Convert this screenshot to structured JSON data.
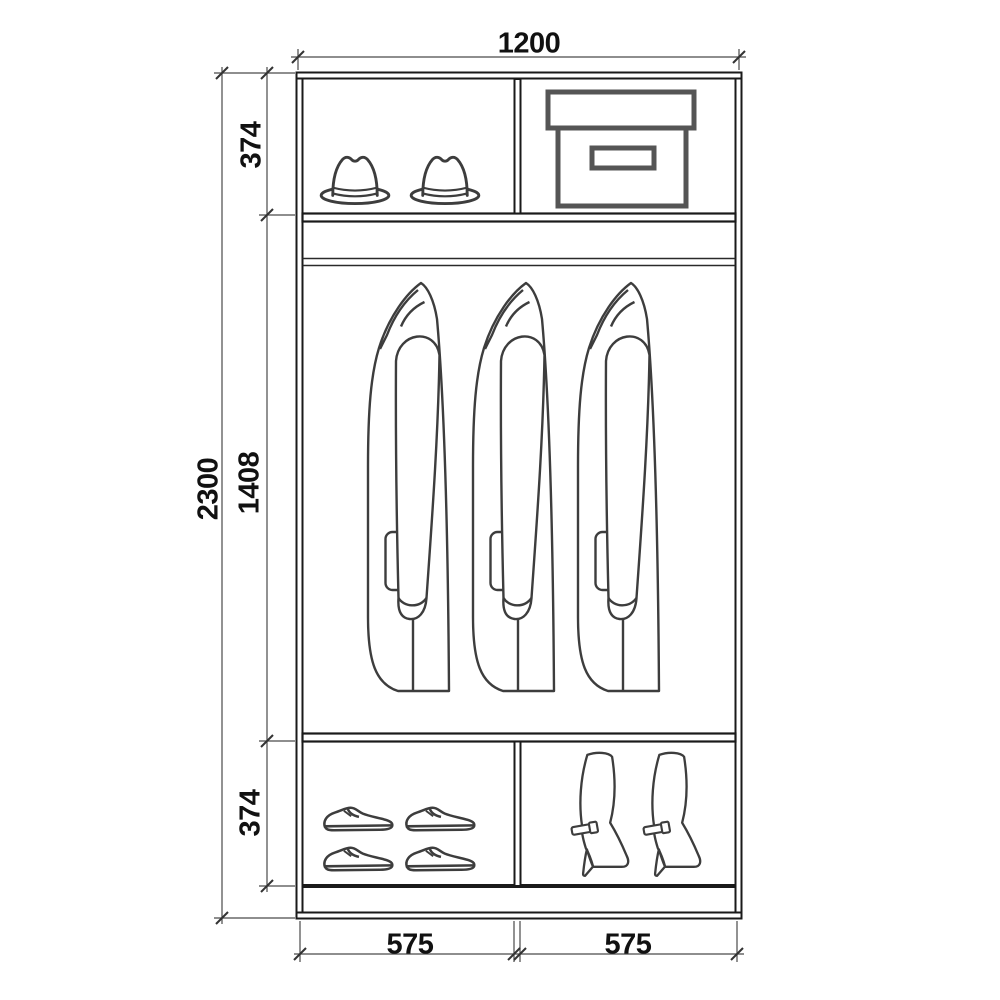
{
  "diagram_title": "wardrobe-interior-elevation",
  "colors": {
    "background": "#ffffff",
    "frame_line": "#1a1a1a",
    "item_line": "#3d3d3d",
    "box_line": "#555555",
    "dimension_line": "#4a4a4a",
    "label_text": "#111111"
  },
  "wardrobe": {
    "dimensions": {
      "overall_width": "1200",
      "overall_height": "2300",
      "sections": {
        "top": "374",
        "middle": "1408",
        "bottom": "374"
      },
      "bays": {
        "left": "575",
        "right": "575"
      }
    },
    "fittings": [
      "top-shelf",
      "hanging-rod",
      "bottom-shelf",
      "center-dividers",
      "base-plinth"
    ],
    "compartments": {
      "top_left": {
        "items": [
          "fedora-hat",
          "fedora-hat"
        ]
      },
      "top_right": {
        "items": [
          "storage-box"
        ]
      },
      "middle": {
        "items": [
          "coat",
          "coat",
          "coat"
        ]
      },
      "bottom_left": {
        "items": [
          "dress-shoe",
          "dress-shoe",
          "dress-shoe",
          "dress-shoe"
        ]
      },
      "bottom_right": {
        "items": [
          "high-heel-boot",
          "high-heel-boot"
        ]
      }
    }
  }
}
